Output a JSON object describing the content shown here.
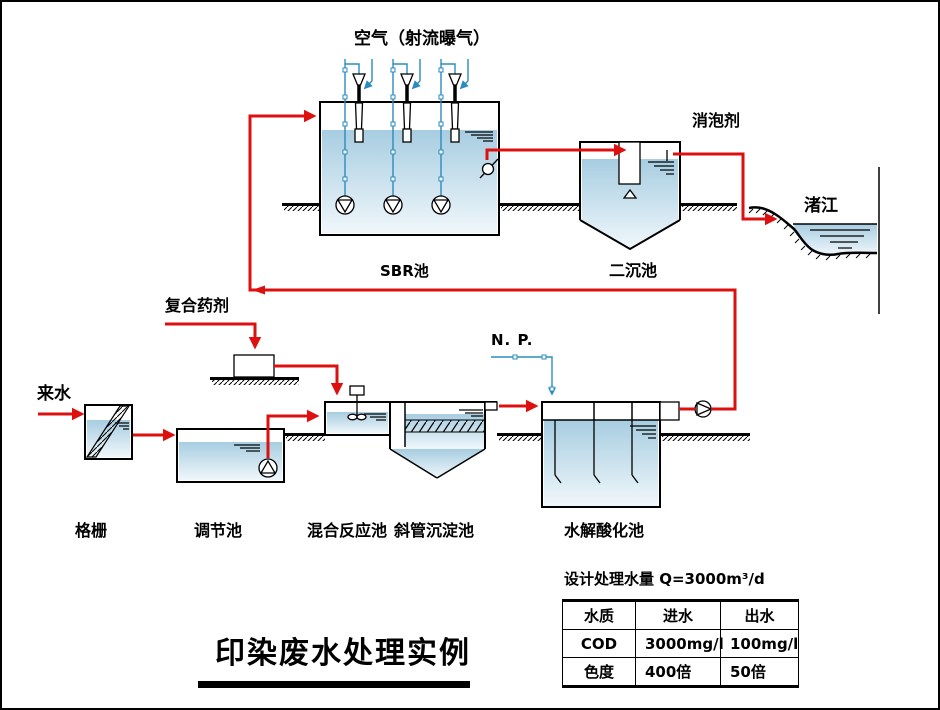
{
  "title": {
    "text": "印染废水处理实例"
  },
  "colors": {
    "pipe_red": "#dd1010",
    "pipe_blue": "#2a8cbe",
    "water_top": "#a7cde1",
    "water_bottom": "#f0f7fb"
  },
  "labels": {
    "air": "空气（射流曝气）",
    "defoamer": "消泡剂",
    "river": "渚江",
    "sbr_tank": "SBR池",
    "secondary_clarifier": "二沉池",
    "compound_chemical": "复合药剂",
    "influent": "来水",
    "nutrient": "N. P.",
    "bar_screen": "格栅",
    "equalization_tank": "调节池",
    "mixing_reaction_tank": "混合反应池",
    "inclined_tube_clarifier": "斜管沉淀池",
    "hydrolysis_acidification_tank": "水解酸化池"
  },
  "design": {
    "capacity": "设计处理水量 Q=3000m³/d"
  },
  "table": {
    "headers": [
      "水质",
      "进水",
      "出水"
    ],
    "rows": [
      [
        "COD",
        "3000mg/l",
        "100mg/l"
      ],
      [
        "色度",
        "400倍",
        "50倍"
      ]
    ]
  }
}
